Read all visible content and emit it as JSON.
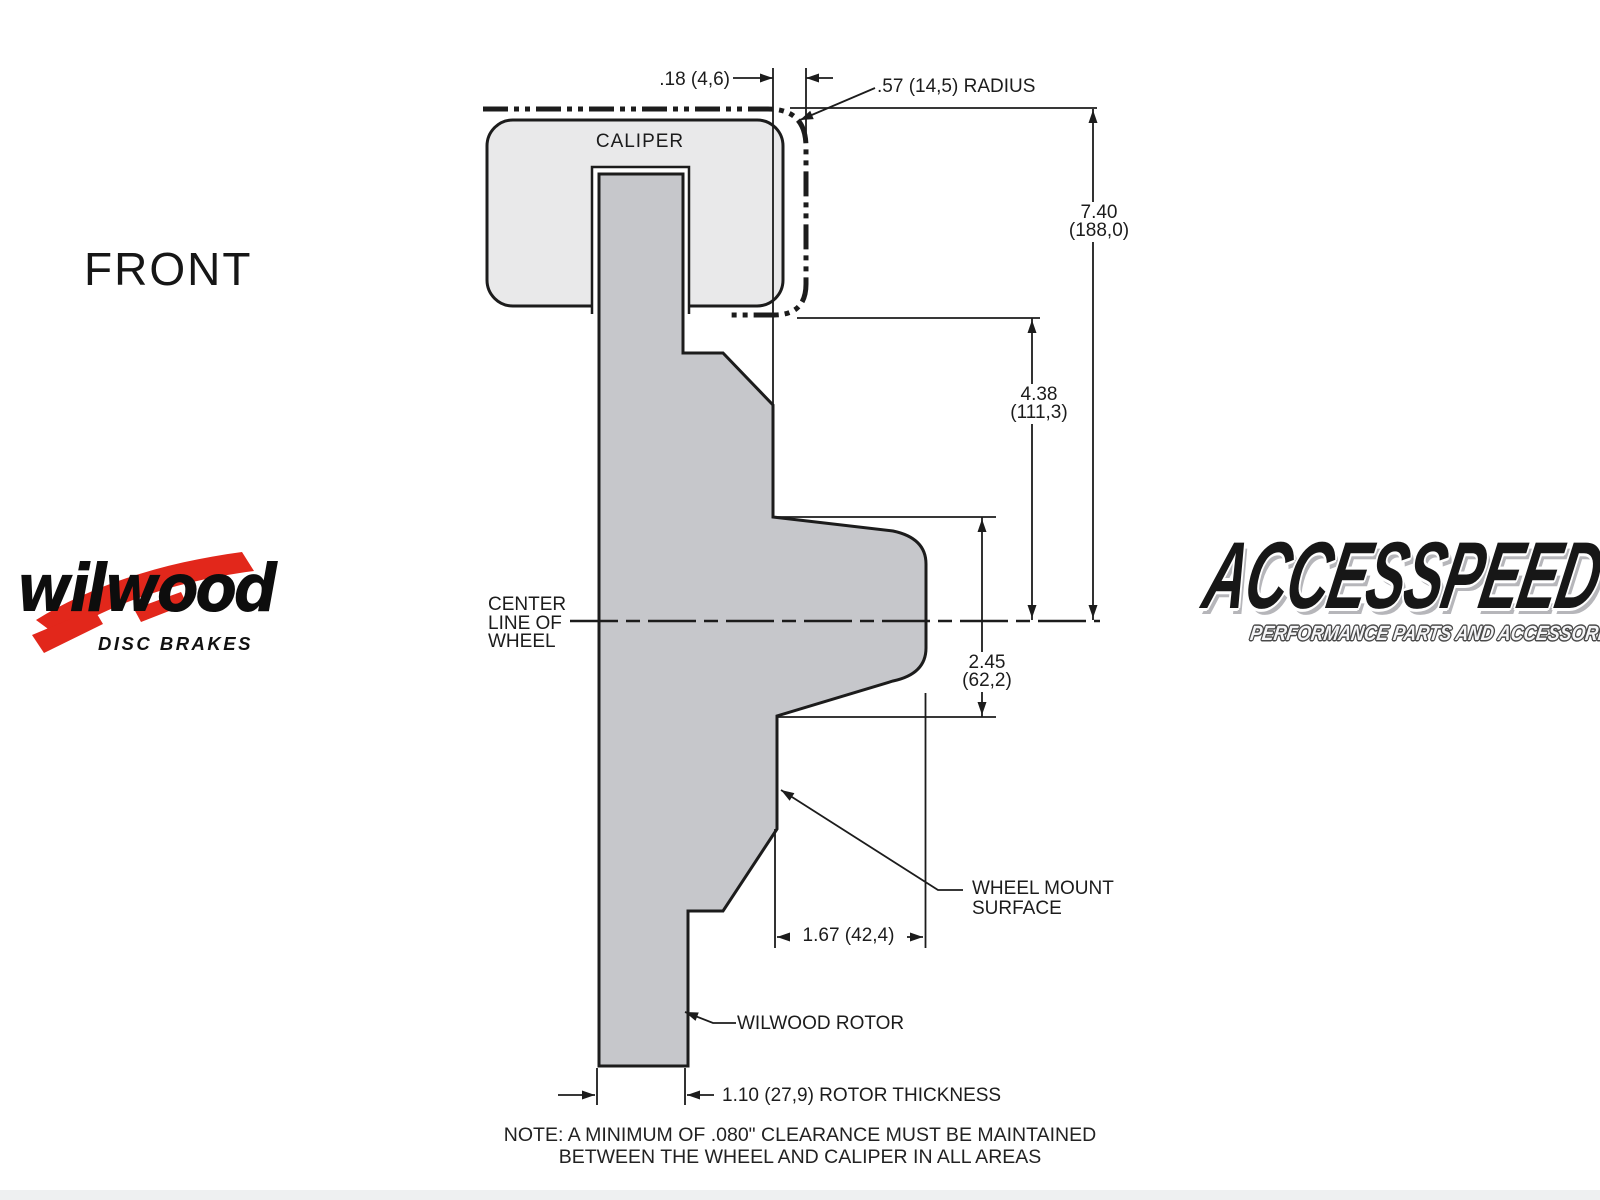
{
  "front_label": "FRONT",
  "caliper_label": "CALIPER",
  "centerline": {
    "l1": "CENTER",
    "l2": "LINE OF",
    "l3": "WHEEL"
  },
  "dims": {
    "gap": ".18 (4,6)",
    "radius": ".57 (14,5) RADIUS",
    "overall_in": "7.40",
    "overall_mm": "(188,0)",
    "upper_in": "4.38",
    "upper_mm": "(111,3)",
    "hub_in": "2.45",
    "hub_mm": "(62,2)",
    "mount_depth": "1.67 (42,4)",
    "rotor_thickness": "1.10 (27,9) ROTOR THICKNESS"
  },
  "callouts": {
    "wheel_mount_l1": "WHEEL MOUNT",
    "wheel_mount_l2": "SURFACE",
    "rotor": "WILWOOD ROTOR"
  },
  "note_l1": "NOTE: A MINIMUM OF .080\" CLEARANCE MUST BE MAINTAINED",
  "note_l2": "BETWEEN THE WHEEL AND CALIPER IN ALL AREAS",
  "logos": {
    "wilwood_name": "wilwood",
    "wilwood_tagline": "DISC BRAKES",
    "accesspeed_name": "ACCESSPEED",
    "accesspeed_tagline": "PERFORMANCE PARTS AND ACCESSORIES"
  },
  "colors": {
    "line": "#1c1c1c",
    "rotor_fill": "#c6c7cb",
    "caliper_fill": "#e9e9ea",
    "wilwood_red": "#e2271b"
  }
}
